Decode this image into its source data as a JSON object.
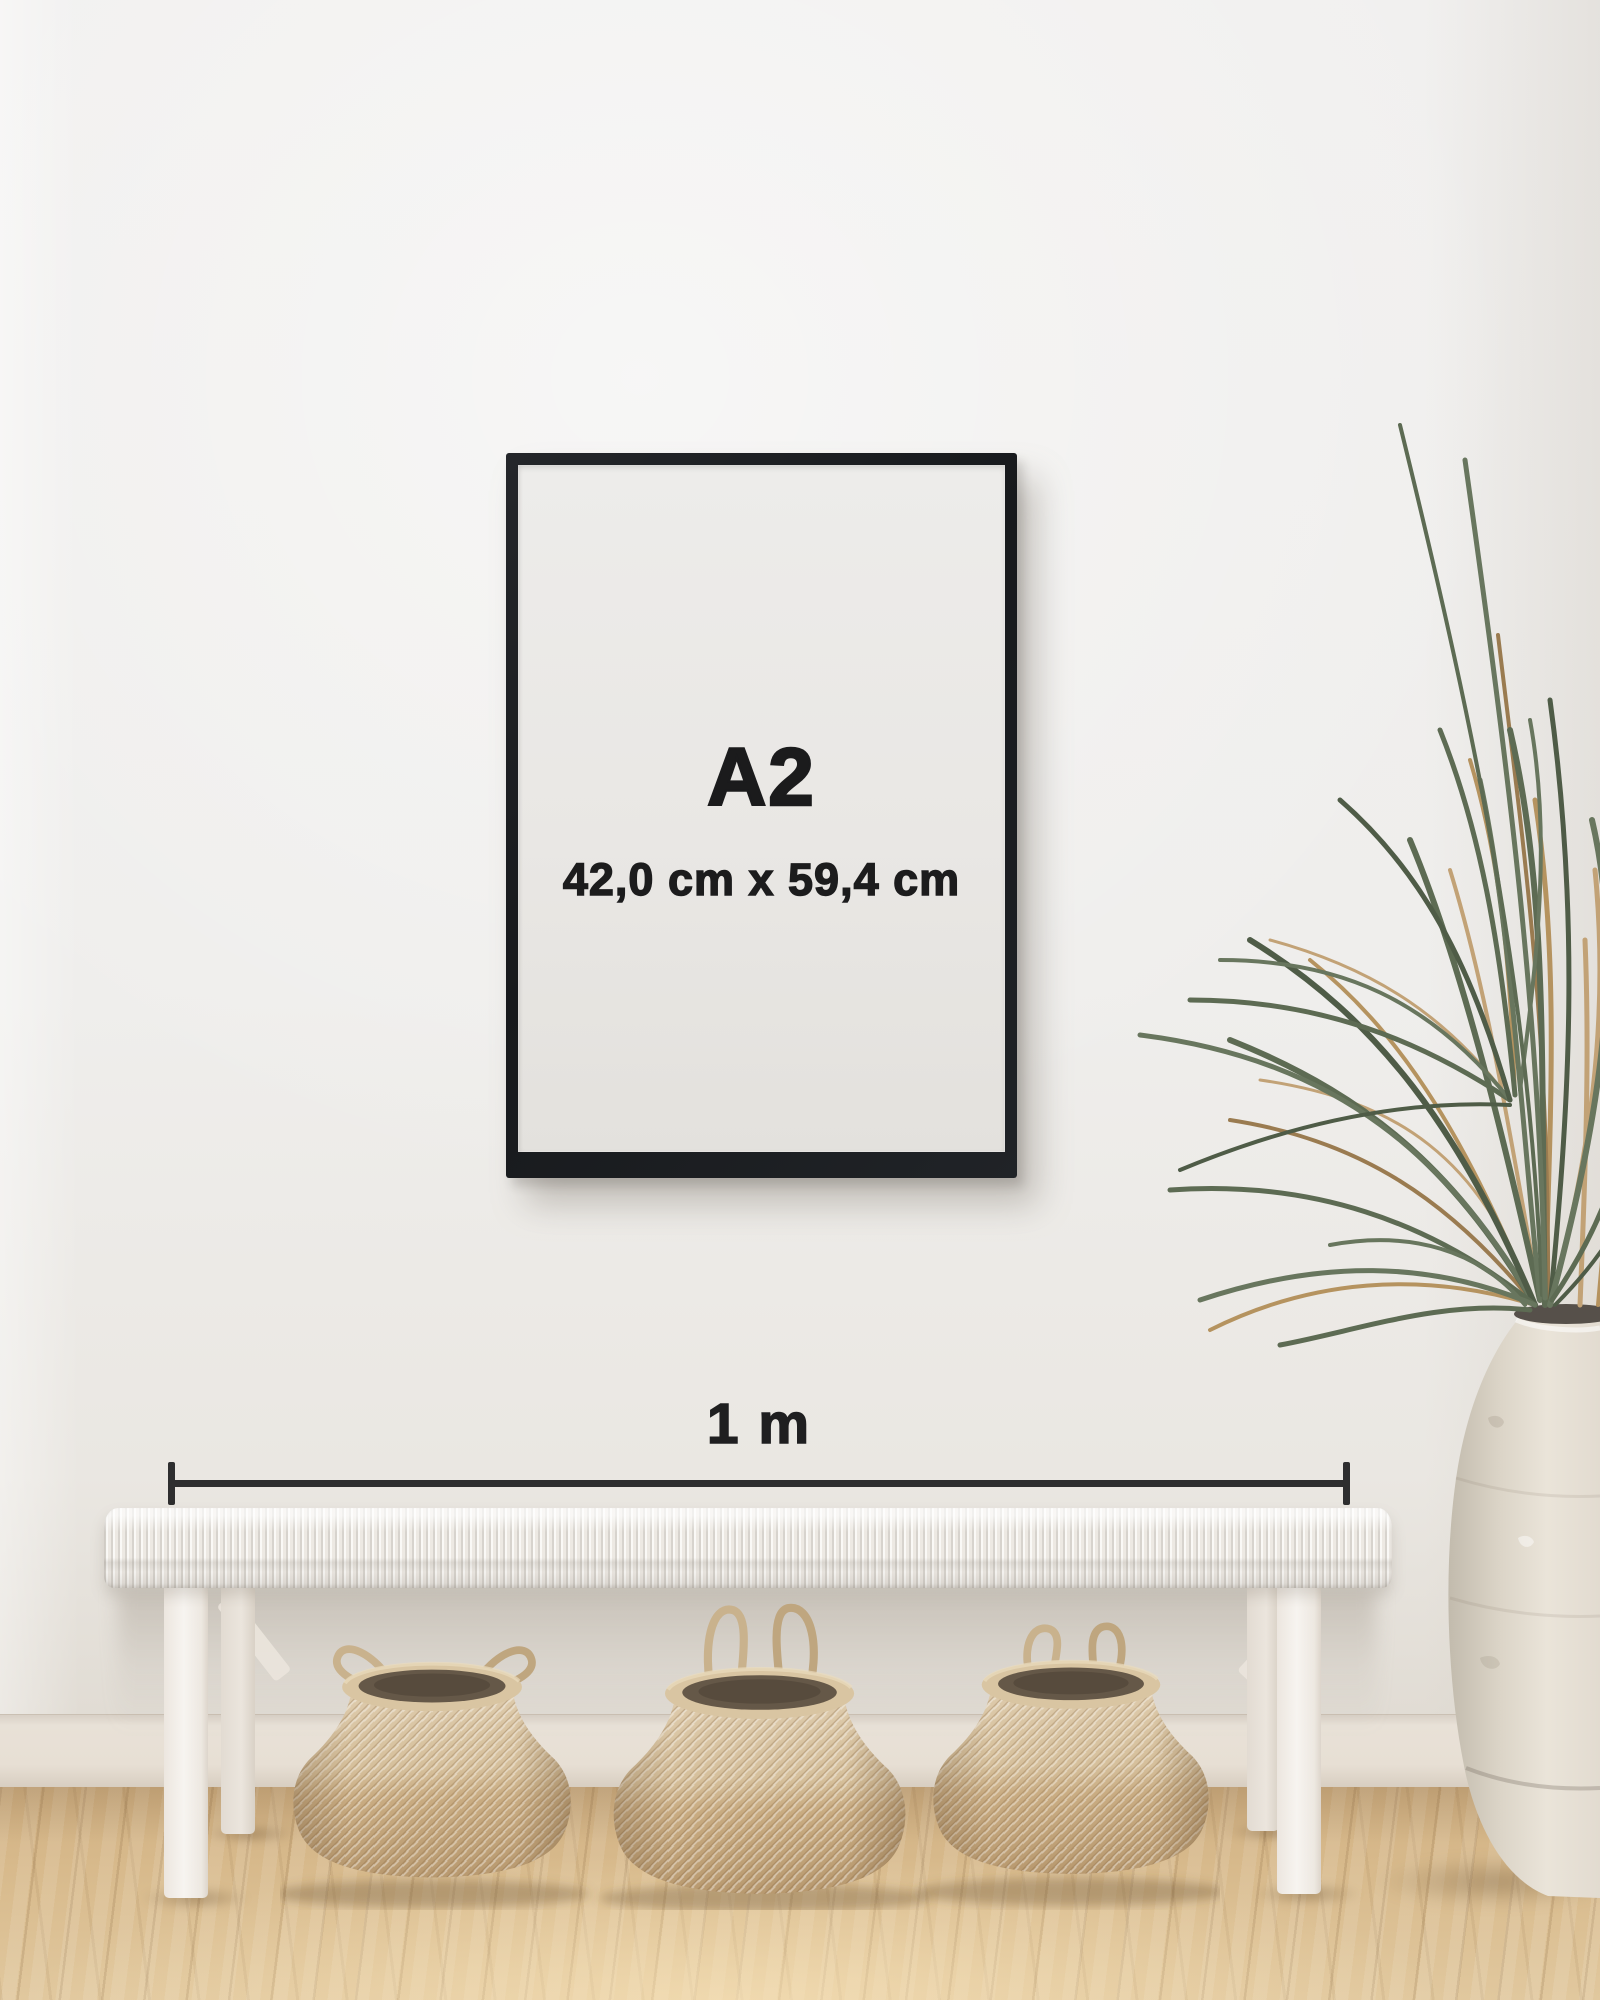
{
  "poster": {
    "size_label": "A2",
    "dimensions_label": "42,0 cm x 59,4 cm"
  },
  "scale_bar": {
    "label": "1 m"
  },
  "colors": {
    "frame_black": "#1a1c1f",
    "poster_paper": "#e9e7e4",
    "text": "#1b1b1c",
    "measure_line": "#2e2e2f",
    "wall": "#efeeec",
    "baseboard": "#e6ded3",
    "floor_light": "#e1c89e",
    "floor_dark": "#c49d6d",
    "bench_white": "#f4f1ec",
    "basket_light": "#d9c5a3",
    "basket_dark": "#bd9f76",
    "basket_interior": "#645747",
    "rope": "#c7b08c",
    "leaf_green": "#5d6b53",
    "leaf_dry": "#b5935f",
    "vase": "#e6e0d5"
  }
}
